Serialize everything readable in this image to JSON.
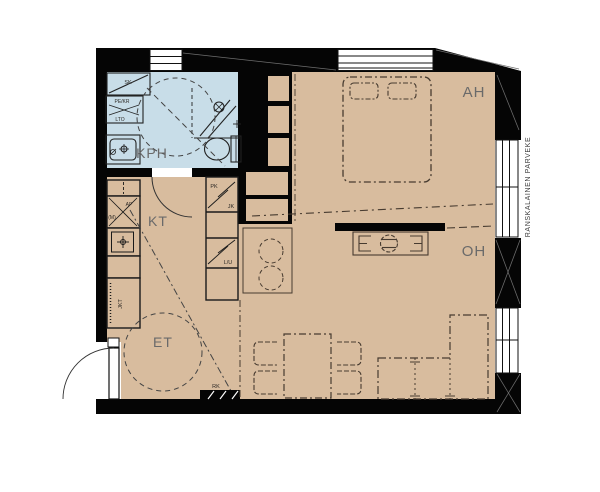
{
  "plan_title": "apartment-floor-plan",
  "rooms": {
    "bathroom": "KPH",
    "kitchen": "KT",
    "entry": "ET",
    "bedroom": "AH",
    "living": "OH"
  },
  "fixtures": {
    "cleaning_closet": "SK",
    "washer_dryer": "PE/KR",
    "heat_recovery": "LTO",
    "dishwasher": "AP",
    "microwave": "(M)",
    "fridge_tall": "JKT",
    "freezer": "PK",
    "fridge": "JK",
    "stove_oven": "L/U",
    "electrical_panel": "RK"
  },
  "balcony": {
    "label": "RANSKALAINEN PARVEKE"
  },
  "colors": {
    "floor": "#d8bc9e",
    "bathroom_floor": "#c8dde8",
    "wall": "#050505",
    "furniture_line": "#473b30"
  }
}
